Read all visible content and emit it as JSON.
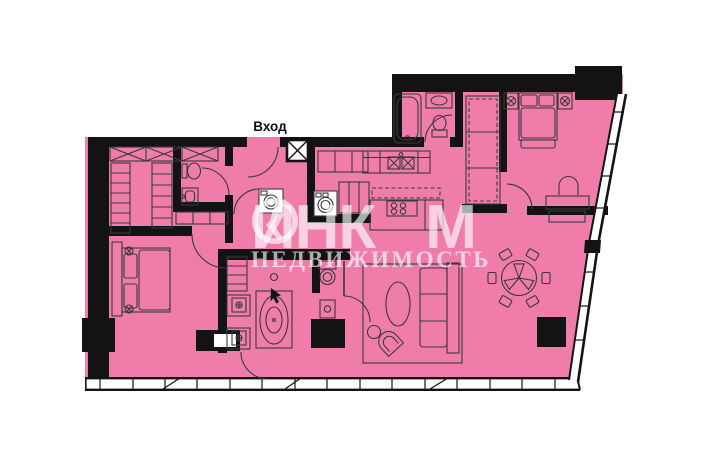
{
  "floor_plan": {
    "entrance_label": "Вход",
    "watermark": {
      "brand_part1": "ИНК",
      "brand_part2": "М",
      "brand_full": "ИНКОМ",
      "subtitle": "НЕДВИЖИМОСТЬ"
    },
    "colors": {
      "floor_pink": "#ef7ca9",
      "wall_black": "#131313",
      "furniture_line": "#3a3a3a",
      "window_white": "#ffffff",
      "background": "#ffffff",
      "watermark_white": "rgba(255,255,255,0.65)"
    }
  }
}
